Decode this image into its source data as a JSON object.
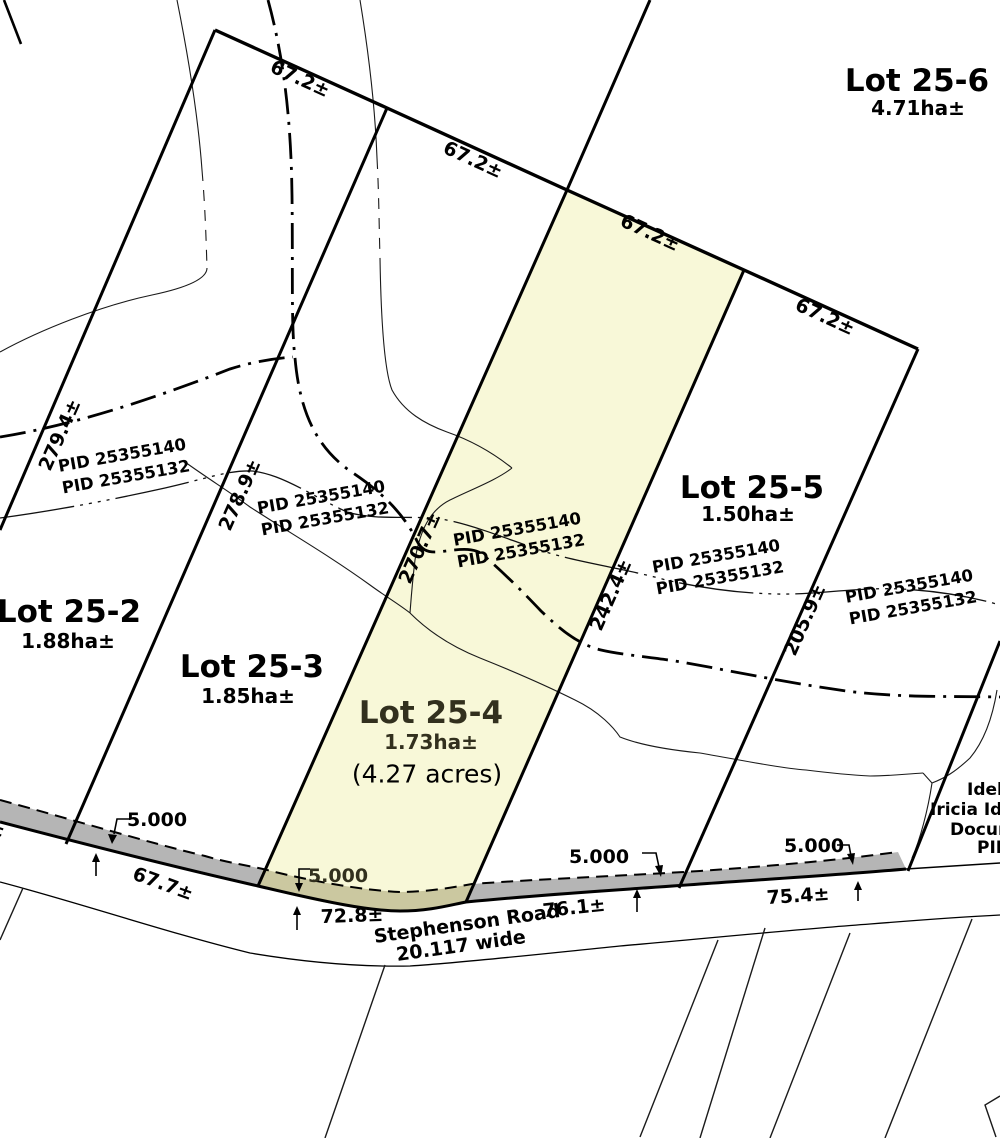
{
  "plan": {
    "lots": [
      {
        "name": "Lot 25-2",
        "area": "1.88ha±"
      },
      {
        "name": "Lot 25-3",
        "area": "1.85ha±"
      },
      {
        "name": "Lot 25-4",
        "area": "1.73ha±",
        "area_acres": "(4.27 acres)"
      },
      {
        "name": "Lot 25-5",
        "area": "1.50ha±"
      },
      {
        "name": "Lot 25-6",
        "area": "4.71ha±"
      }
    ],
    "north_frontage_dims": [
      "67.2±",
      "67.2±",
      "67.2±",
      "67.2±"
    ],
    "side_dims": [
      "279.4±",
      "278.9±",
      "270.7±",
      "242.4±",
      "205.9±"
    ],
    "pid_pairs": [
      {
        "line1": "PID 25355140",
        "line2": "PID 25355132"
      },
      {
        "line1": "PID 25355140",
        "line2": "PID 25355132"
      },
      {
        "line1": "PID 25355140",
        "line2": "PID 25355132"
      },
      {
        "line1": "PID 25355140",
        "line2": "PID 25355132"
      },
      {
        "line1": "PID 25355140",
        "line2": "PID 25355132"
      }
    ],
    "road": {
      "name": "Stephenson Road",
      "width_note": "20.117 wide",
      "frontage_dims": [
        "67.7±",
        "72.8±",
        "76.1±",
        "75.4±"
      ],
      "widening_dims": [
        "5.000",
        "5.000",
        "5.000",
        "5.000"
      ],
      "left_edge_fragment": "±"
    },
    "adjacent_text_fragments": [
      "Idel",
      "Iricia Ide",
      "Docum",
      "PID"
    ],
    "colors": {
      "highlight_lot_fill": "#F8F8D8",
      "widening_strip_gray": "#B5B5B5",
      "widening_strip_on_lot": "#CBC8A0"
    }
  }
}
